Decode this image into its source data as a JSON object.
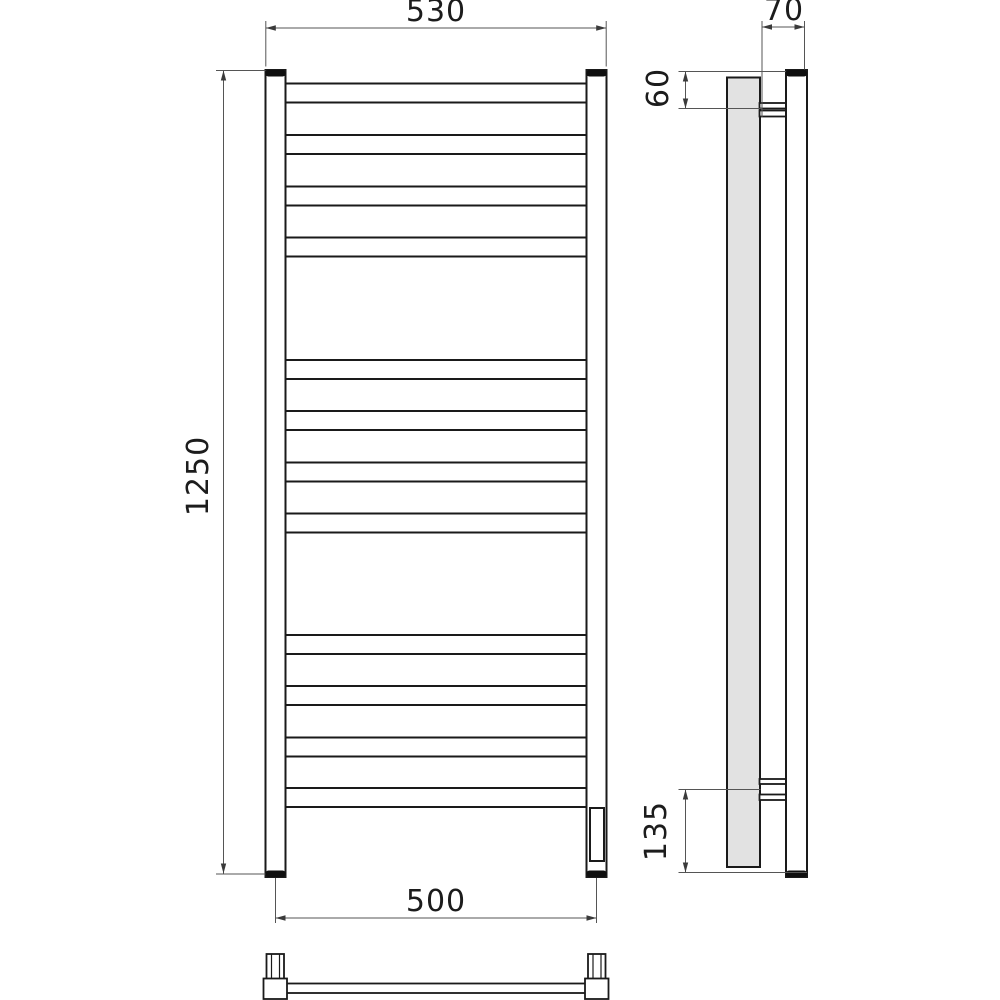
{
  "drawing": {
    "dimensions": {
      "front_width_top": "530",
      "front_height": "1250",
      "front_width_bottom": "500",
      "side_depth": "70",
      "side_top_bracket_offset": "60",
      "side_bottom_bracket_offset": "135"
    },
    "colors": {
      "line": "#1a1a1a",
      "dimension_line": "#555555",
      "panel_fill": "#e2e2e2",
      "cap_fill": "#0f0f0f",
      "background": "#ffffff"
    }
  }
}
